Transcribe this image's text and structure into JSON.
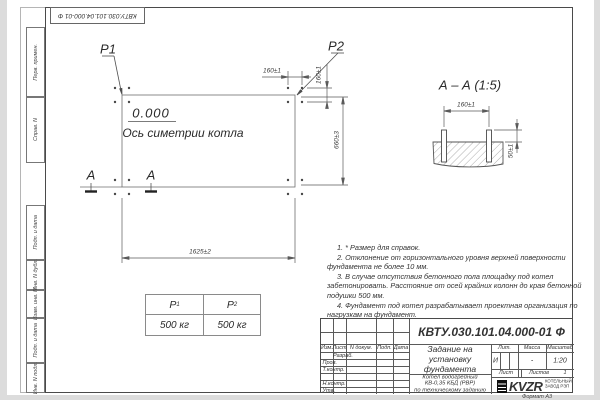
{
  "stamp": {
    "designation_rotated": "КВТУ.030.101.04.000-01 Ф"
  },
  "frame": {
    "upper_labels": [
      "Перв. примен.",
      "Справ. N"
    ],
    "lower_labels": [
      "Подп. и дата",
      "Инв. N дубл.",
      "Взам. инв. N",
      "Подп. и дата",
      "Инв. N подл."
    ],
    "format_note": "Формат А3"
  },
  "plan": {
    "load_point_1": "P1",
    "load_point_2": "P2",
    "elevation": "0.000",
    "symmetry_axis": "Ось симетрии котла",
    "dim_length": "1625±2",
    "dim_width": "660±3",
    "dim_bolt_h": "160±1",
    "dim_bolt_v": "160±1",
    "section_mark": "А"
  },
  "section_view": {
    "title": "А – А (1:5)",
    "dim_bolt_spacing": "160±1",
    "dim_bolt_height": "50±1"
  },
  "load_table": {
    "col1": {
      "base": "P",
      "sub": "1",
      "value": "500 кг"
    },
    "col2": {
      "base": "P",
      "sub": "2",
      "value": "500 кг"
    }
  },
  "notes": [
    "1. * Размер для справок.",
    "2. Отклонение от горизонтального уровня верхней поверхности фундамента не более 10 мм.",
    "3. В случае отсутствия бетонного пола площадку под котел забетонировать. Расстояние от осей крайних колонн до края бетонной подушки 500 мм.",
    "4. Фундамент под котел разрабатывает проектная организация по нагрузкам на фундамент."
  ],
  "title_block": {
    "designation": "КВТУ.030.101.04.000-01 Ф",
    "doc_title": "Задание на установку фундамента",
    "product_line1": "Котел водогрейный",
    "product_line2": "КВ-0,35 КБД (РВР)",
    "product_line3": "по техническому заданию",
    "col_izm": "Изм.",
    "col_list": "Лист",
    "col_ndoc": "N докум.",
    "col_podp": "Подп.",
    "col_data": "Дата",
    "row_razrab": "Разраб.",
    "row_prov": "Пров.",
    "row_tkontr": "Т.контр.",
    "row_nkontr": "Н.контр.",
    "row_utv": "Утв.",
    "lit_label": "Лит.",
    "lit_value": "И",
    "mass_label": "Масса",
    "mass_value": "-",
    "scale_label": "Масштаб",
    "scale_value": "1:20",
    "sheet_label": "Лист",
    "sheets_label": "Листов",
    "sheets_value": "1",
    "logo_text": "KVZR",
    "logo_caption_line1": "КОТЕЛЬНЫЙ",
    "logo_caption_line2": "ЗАВОД РЭП"
  }
}
